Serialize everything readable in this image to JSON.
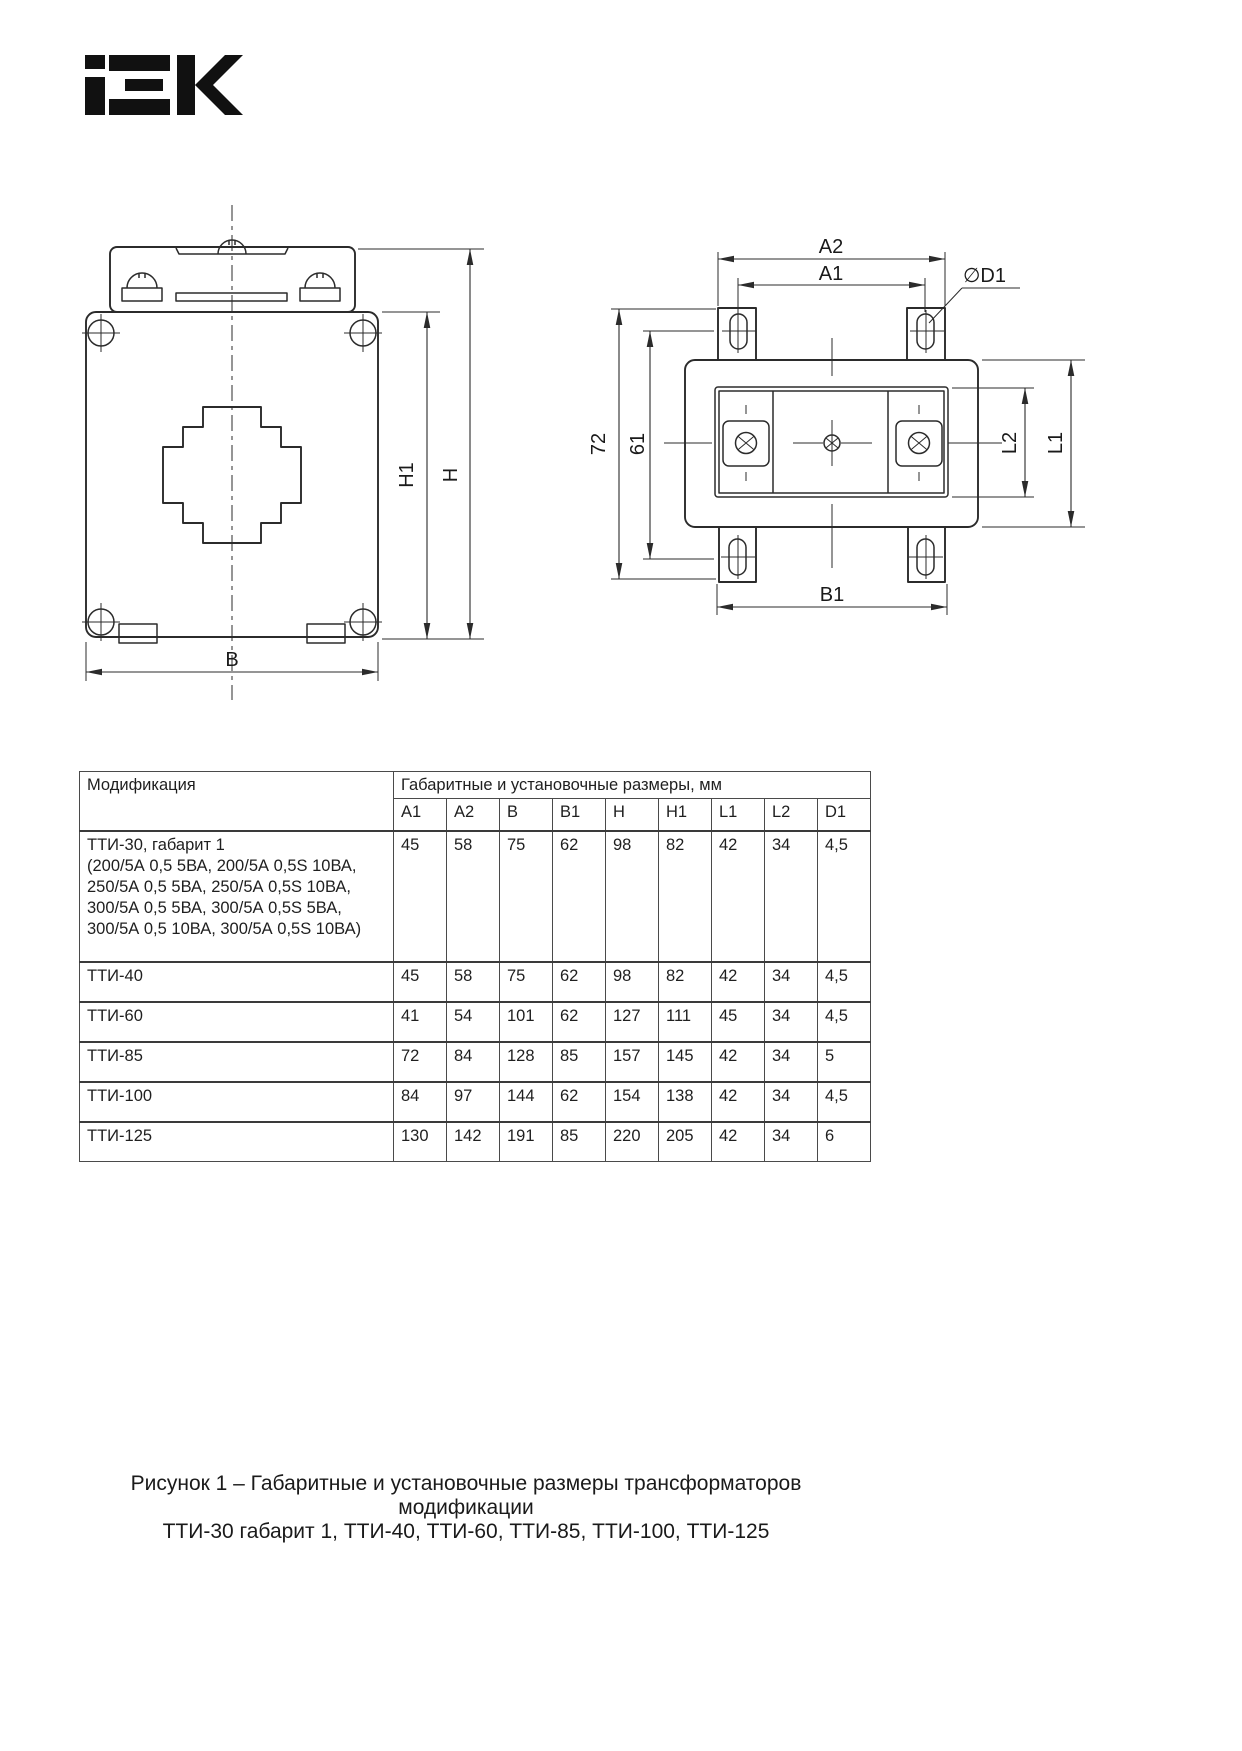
{
  "brand": {
    "logo_name": "IEK"
  },
  "front_view": {
    "labels": {
      "h1": "H1",
      "h": "H",
      "b": "B"
    }
  },
  "top_view": {
    "labels": {
      "a2": "A2",
      "a1": "A1",
      "d1": "∅D1",
      "depth_total": "72",
      "depth_holes": "61",
      "l2": "L2",
      "l1": "L1",
      "b1": "B1"
    }
  },
  "table": {
    "col_modification": "Модификация",
    "col_dimensions": "Габаритные и установочные размеры, мм",
    "dim_headers": [
      "A1",
      "A2",
      "B",
      "B1",
      "H",
      "H1",
      "L1",
      "L2",
      "D1"
    ],
    "rows": [
      {
        "name": "ТТИ-30, габарит 1",
        "name_extra": [
          "(200/5А 0,5 5ВА, 200/5А 0,5S 10ВА,",
          "250/5А 0,5 5ВА, 250/5А 0,5S 10ВА,",
          "300/5А 0,5 5ВА, 300/5А 0,5S 5ВА,",
          "300/5А 0,5 10ВА, 300/5А 0,5S 10ВА)"
        ],
        "values": [
          "45",
          "58",
          "75",
          "62",
          "98",
          "82",
          "42",
          "34",
          "4,5"
        ]
      },
      {
        "name": "ТТИ-40",
        "values": [
          "45",
          "58",
          "75",
          "62",
          "98",
          "82",
          "42",
          "34",
          "4,5"
        ]
      },
      {
        "name": "ТТИ-60",
        "values": [
          "41",
          "54",
          "101",
          "62",
          "127",
          "111",
          "45",
          "34",
          "4,5"
        ]
      },
      {
        "name": "ТТИ-85",
        "values": [
          "72",
          "84",
          "128",
          "85",
          "157",
          "145",
          "42",
          "34",
          "5"
        ]
      },
      {
        "name": "ТТИ-100",
        "values": [
          "84",
          "97",
          "144",
          "62",
          "154",
          "138",
          "42",
          "34",
          "4,5"
        ]
      },
      {
        "name": "ТТИ-125",
        "values": [
          "130",
          "142",
          "191",
          "85",
          "220",
          "205",
          "42",
          "34",
          "6"
        ]
      }
    ]
  },
  "caption": {
    "line1": "Рисунок 1 – Габаритные и установочные размеры трансформаторов модификации",
    "line2": "ТТИ-30 габарит 1, ТТИ-40, ТТИ-60, ТТИ-85, ТТИ-100, ТТИ-125"
  }
}
